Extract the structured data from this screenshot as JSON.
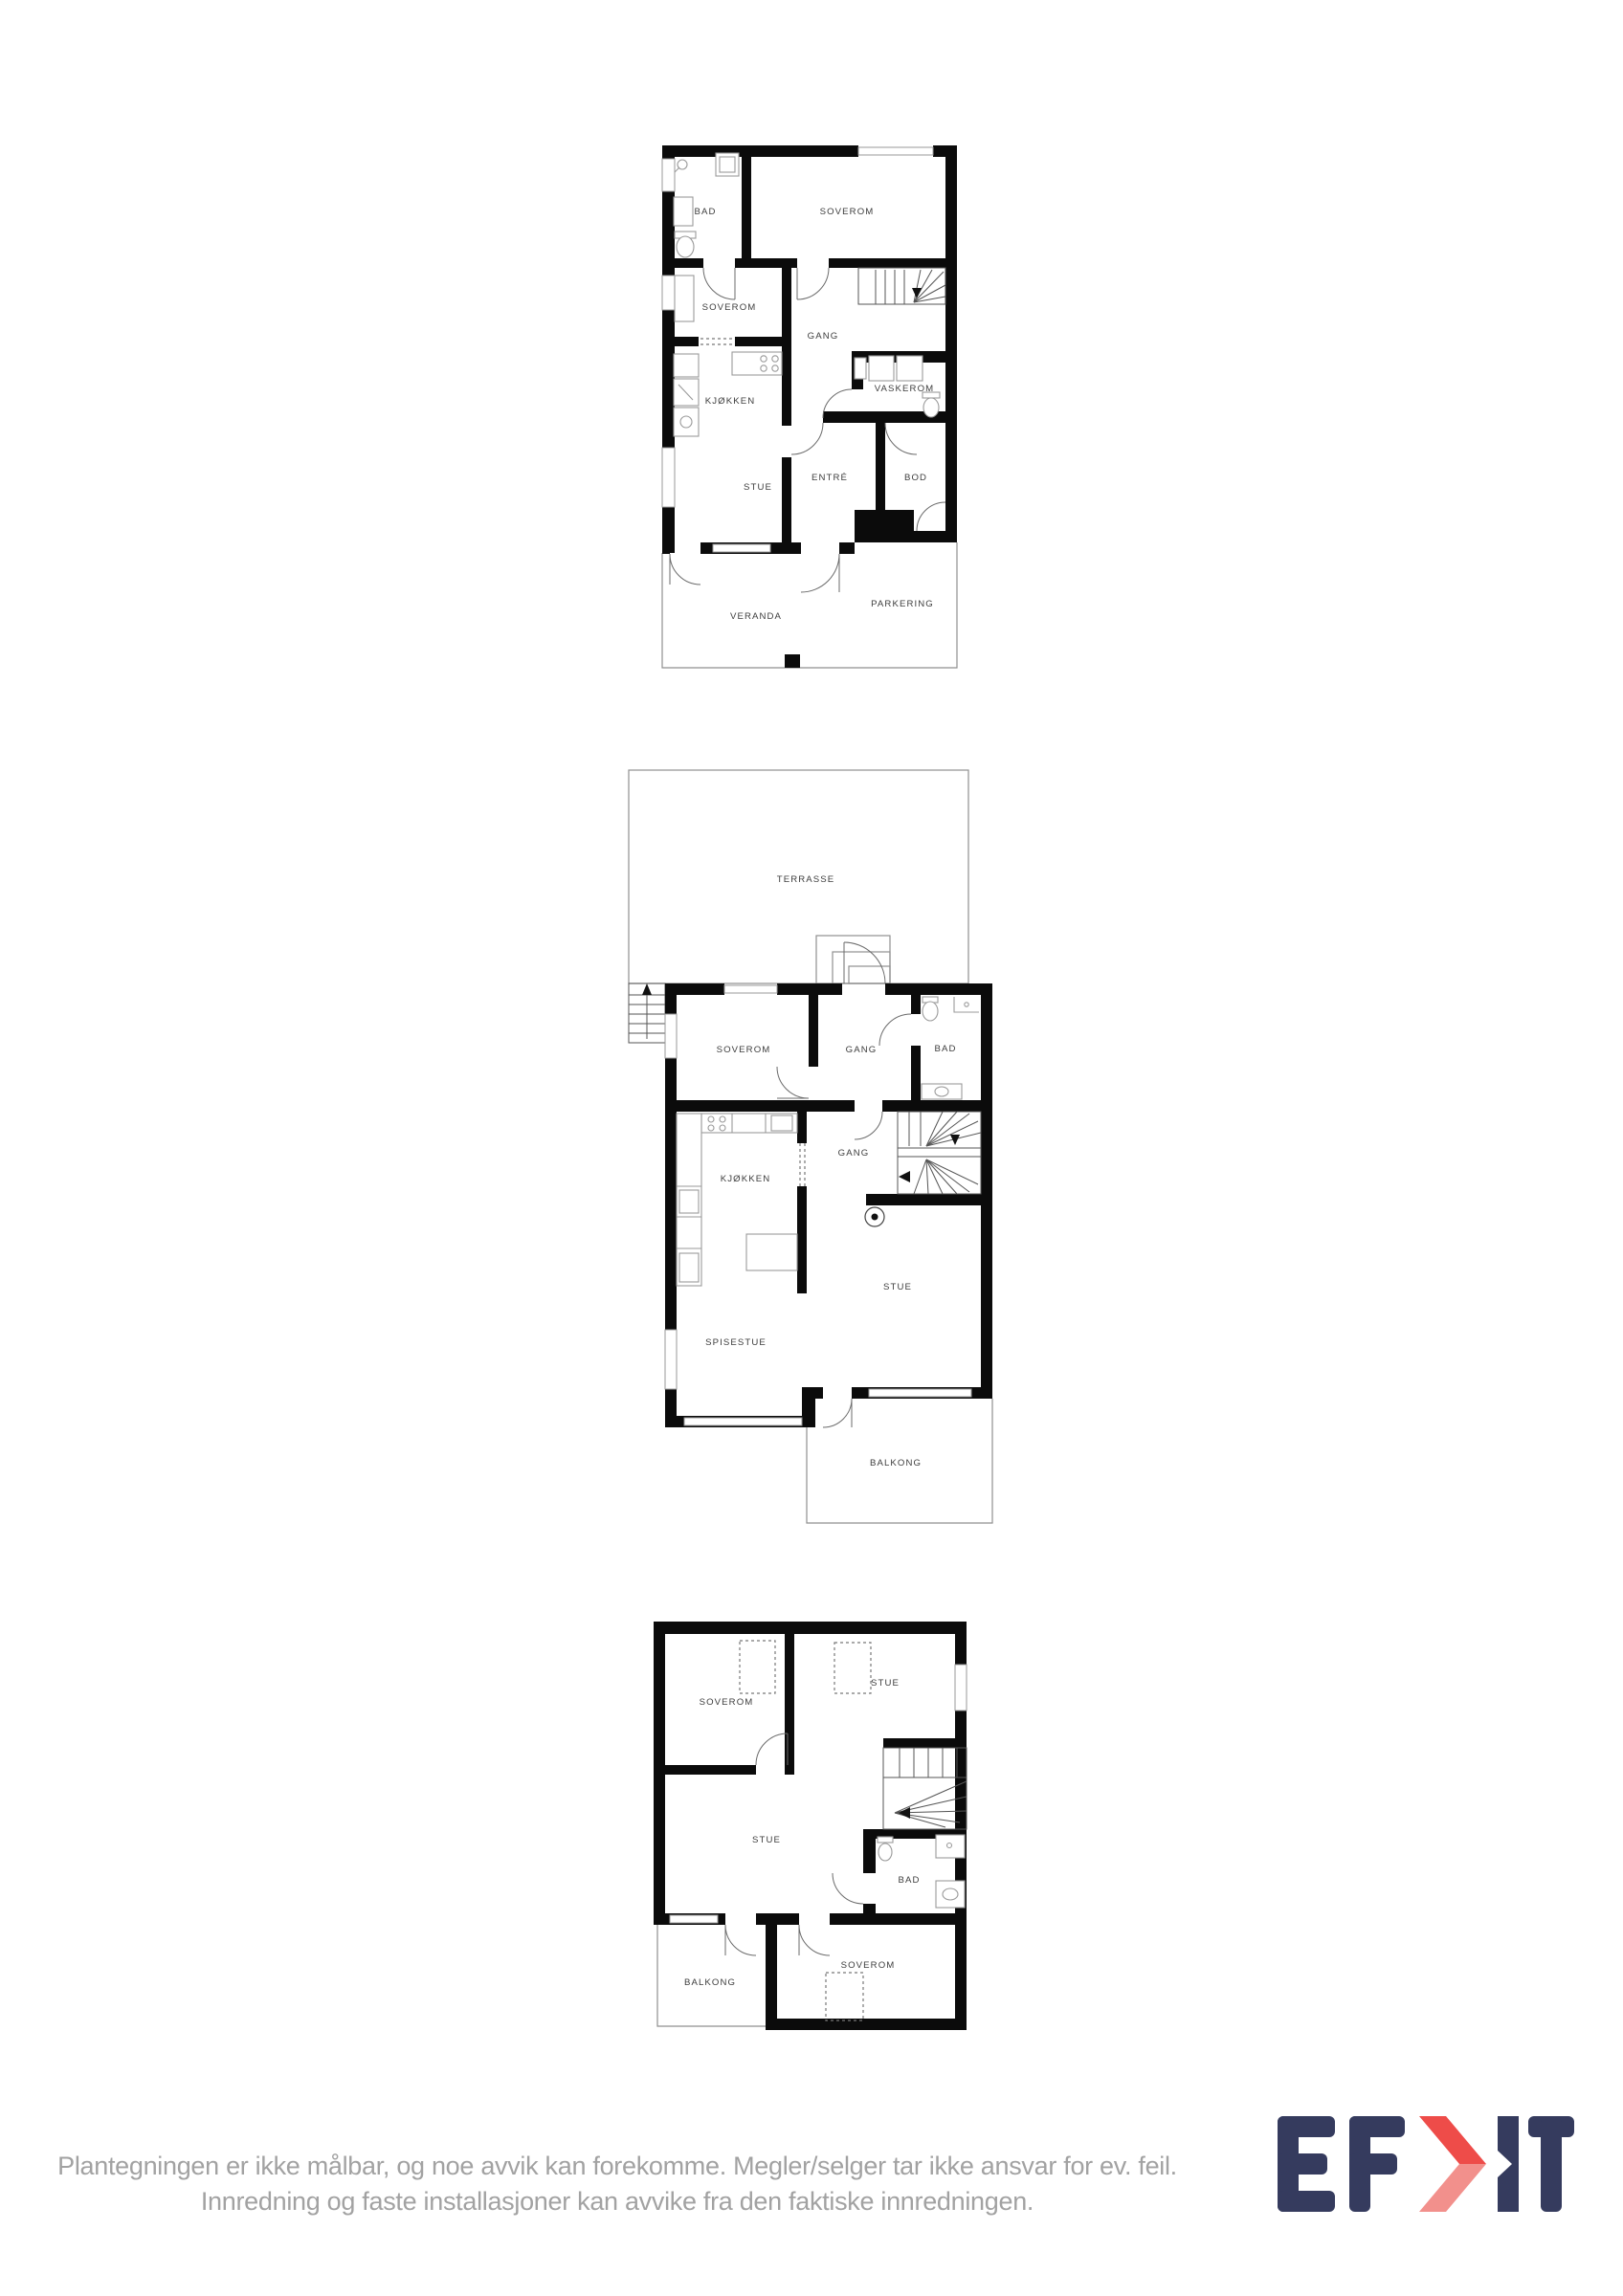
{
  "floor1": {
    "rooms": {
      "bad": "BAD",
      "soverom_top": "SOVEROM",
      "soverom_mid": "SOVEROM",
      "gang": "GANG",
      "vaskerom": "VASKEROM",
      "kjokken": "KJØKKEN",
      "stue": "STUE",
      "entre": "ENTRÉ",
      "bod": "BOD",
      "veranda": "VERANDA",
      "parkering": "PARKERING"
    }
  },
  "floor2": {
    "rooms": {
      "terrasse": "TERRASSE",
      "soverom": "SOVEROM",
      "gang_upper": "GANG",
      "bad": "BAD",
      "kjokken": "KJØKKEN",
      "gang_lower": "GANG",
      "stue": "STUE",
      "spisestue": "SPISESTUE",
      "balkong": "BALKONG"
    }
  },
  "floor3": {
    "rooms": {
      "soverom_top": "SOVEROM",
      "stue_top": "STUE",
      "stue": "STUE",
      "bad": "BAD",
      "balkong": "BALKONG",
      "soverom_bottom": "SOVEROM"
    }
  },
  "disclaimer": {
    "line1": "Plantegningen er ikke målbar, og noe avvik kan forekomme. Megler/selger tar ikke ansvar for ev. feil.",
    "line2": "Innredning og faste installasjoner kan avvike fra den faktiske innredningen."
  },
  "logo": {
    "brand": "EFKT",
    "navy": "#353b5e",
    "red": "#ee4c49",
    "red_light": "#f2908c"
  }
}
